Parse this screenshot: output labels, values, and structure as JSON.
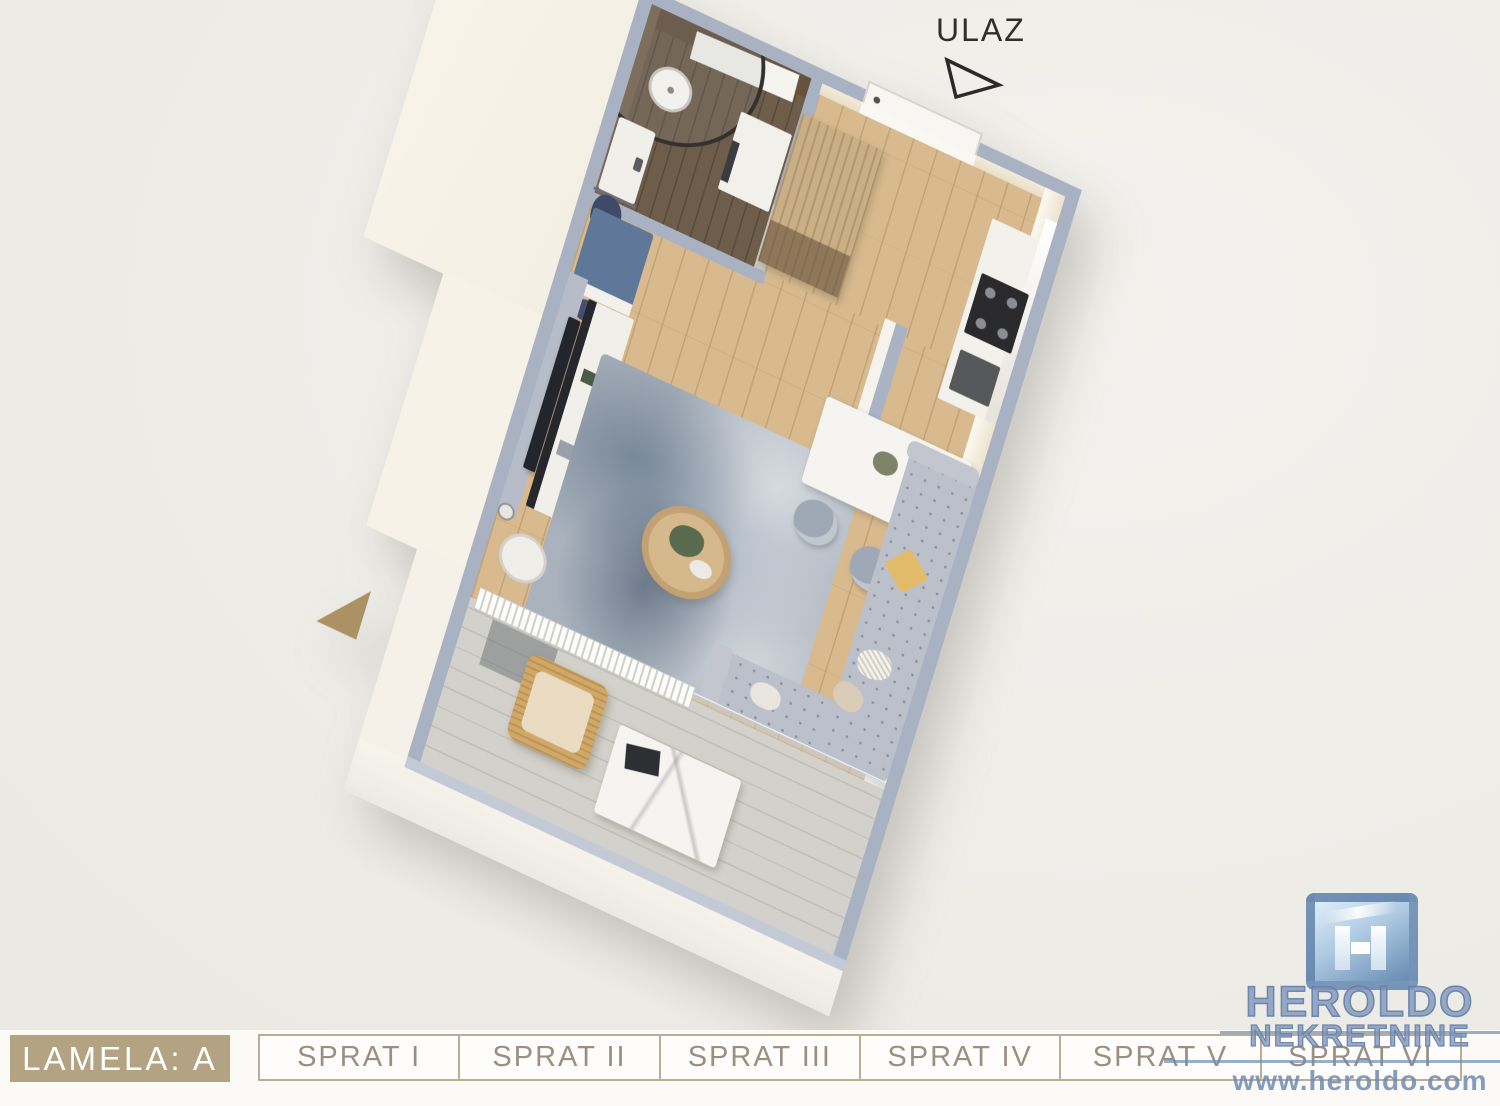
{
  "page": {
    "background": "#f0eeea",
    "footer_background": "#fbfaf7"
  },
  "plan": {
    "entrance_label": "ULAZ",
    "colors": {
      "wall_top": "#a9b2c3",
      "wall_face": "#f6f2e7",
      "wood_floor": "#d8ba8e",
      "bathroom_floor": "#6f5d4b",
      "terrace_floor": "#d3d1cb",
      "rug": "#a9b2bd",
      "sofa": "#bcc0ca",
      "wardrobe_wood": "#c9ae86",
      "bench_blue": "#5f7899"
    },
    "icons": {
      "entrance_arrow": "triangle-outline-arrow"
    }
  },
  "footer": {
    "lamela": {
      "label": "LAMELA: A",
      "background": "#b4a383",
      "text_color": "#ffffff"
    },
    "tabs": [
      {
        "label": "SPRAT I"
      },
      {
        "label": "SPRAT II"
      },
      {
        "label": "SPRAT III"
      },
      {
        "label": "SPRAT IV"
      },
      {
        "label": "SPRAT V"
      },
      {
        "label": "SPRAT VI"
      }
    ],
    "tab_text_color": "#9a8f81",
    "tab_border_color": "#bdae93"
  },
  "watermark": {
    "brand_line1": "HEROLDO",
    "brand_line2": "NEKRETNINE",
    "url": "www.heroldo.com",
    "color": "#7d93b8",
    "logo_icon": "heroldo-h-logo"
  }
}
